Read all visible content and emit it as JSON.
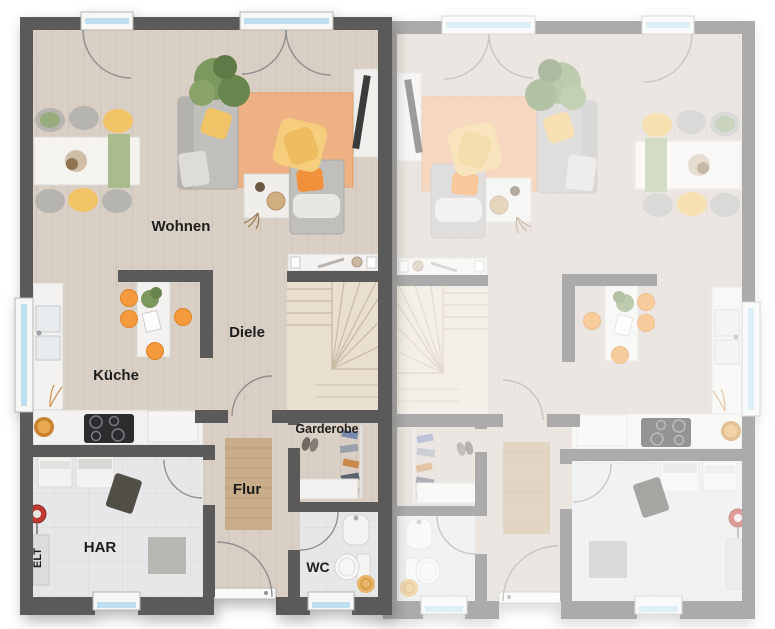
{
  "floorplan": {
    "room_labels": {
      "wohnen": "Wohnen",
      "diele": "Diele",
      "kueche": "Küche",
      "garderobe": "Garderobe",
      "flur": "Flur",
      "har": "HAR",
      "wc": "WC",
      "elt": "ELT"
    },
    "colors": {
      "wall": "#5a5a5a",
      "label_text": "#1d1d1d",
      "floor_wood": "#d9cfc4",
      "floor_wood_line": "#cdc2b5",
      "floor_tile": "#e5e7e9",
      "floor_tile_line": "#d6d8da",
      "stairs": "#e9dfd1",
      "rug_living": "#eeb183",
      "rug_hall": "#c9ad8b",
      "accent_orange": "#f2913c",
      "stool_orange": "#f59b3d",
      "accent_yellow": "#f1c468",
      "blanket_yellow": "#f5cd7d",
      "plant_green": "#7c985f",
      "window_glass": "#bedff0",
      "sofa_gray": "#c0bfbc"
    }
  }
}
